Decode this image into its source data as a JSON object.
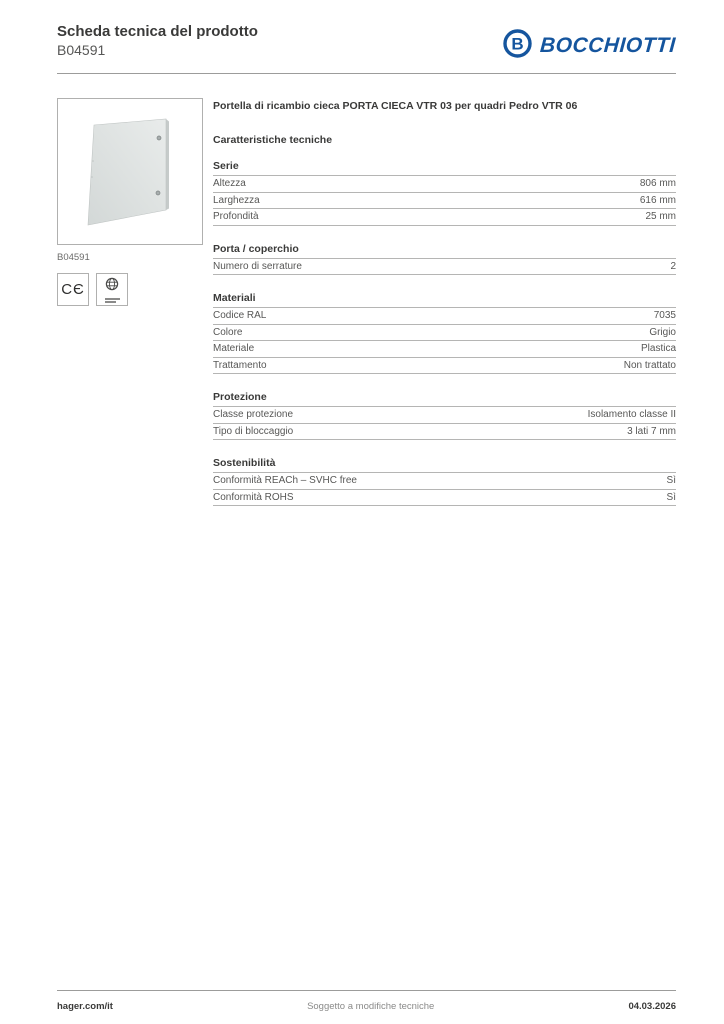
{
  "header": {
    "title": "Scheda tecnica del prodotto",
    "product_code": "B04591",
    "brand": "BOCCHIOTTI",
    "brand_color": "#15559e"
  },
  "product": {
    "title": "Portella di ricambio cieca PORTA CIECA VTR 03 per quadri Pedro VTR 06",
    "image_caption": "B04591"
  },
  "icons": {
    "ce_mark": "CE",
    "ce_mark_glyph": "CЄ",
    "certification_globe": "certification-globe-icon"
  },
  "specs": {
    "heading": "Caratteristiche tecniche",
    "sections": [
      {
        "title": "Serie",
        "rows": [
          {
            "label": "Altezza",
            "value": "806 mm"
          },
          {
            "label": "Larghezza",
            "value": "616 mm"
          },
          {
            "label": "Profondità",
            "value": "25 mm"
          }
        ]
      },
      {
        "title": "Porta / coperchio",
        "rows": [
          {
            "label": "Numero di serrature",
            "value": "2"
          }
        ]
      },
      {
        "title": "Materiali",
        "rows": [
          {
            "label": "Codice RAL",
            "value": "7035"
          },
          {
            "label": "Colore",
            "value": "Grigio"
          },
          {
            "label": "Materiale",
            "value": "Plastica"
          },
          {
            "label": "Trattamento",
            "value": "Non trattato"
          }
        ]
      },
      {
        "title": "Protezione",
        "rows": [
          {
            "label": "Classe protezione",
            "value": "Isolamento classe II"
          },
          {
            "label": "Tipo di bloccaggio",
            "value": "3 lati 7 mm"
          }
        ]
      },
      {
        "title": "Sostenibilità",
        "rows": [
          {
            "label": "Conformità REACh – SVHC free",
            "value": "Sì"
          },
          {
            "label": "Conformità ROHS",
            "value": "Sì"
          }
        ]
      }
    ]
  },
  "footer": {
    "site": "hager.com/it",
    "note": "Soggetto a modifiche tecniche",
    "date": "04.03.2026"
  }
}
